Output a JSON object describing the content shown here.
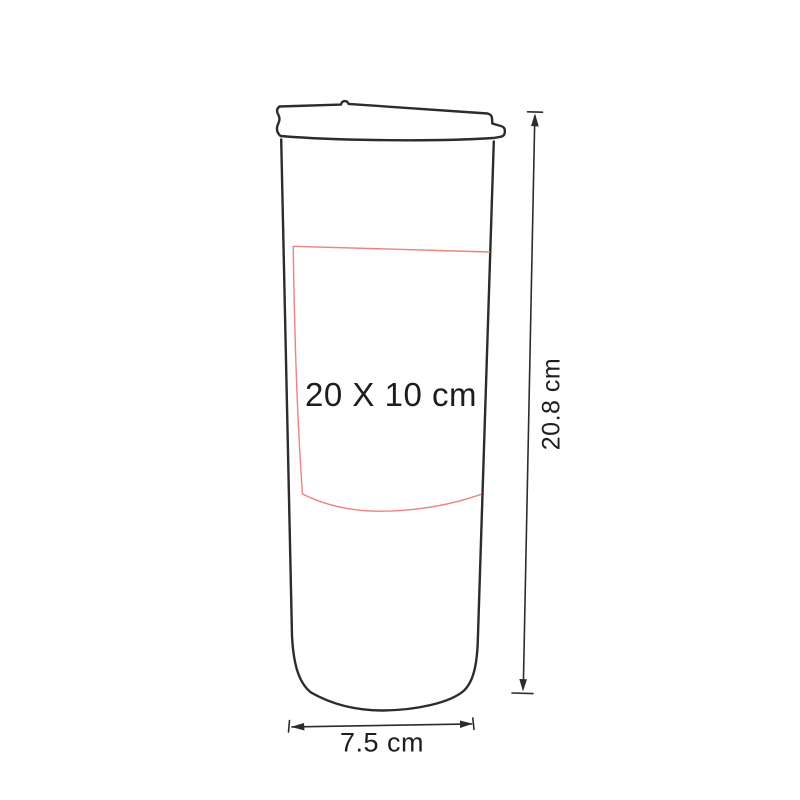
{
  "diagram": {
    "print_area": {
      "label": "20 X 10 cm"
    },
    "height": {
      "label": "20.8 cm"
    },
    "width": {
      "label": "7.5 cm"
    },
    "colors": {
      "outline": "#2c2c2c",
      "print_area_stroke": "#ed837b",
      "label_text": "#1d1d1d",
      "background": "#ffffff"
    }
  }
}
